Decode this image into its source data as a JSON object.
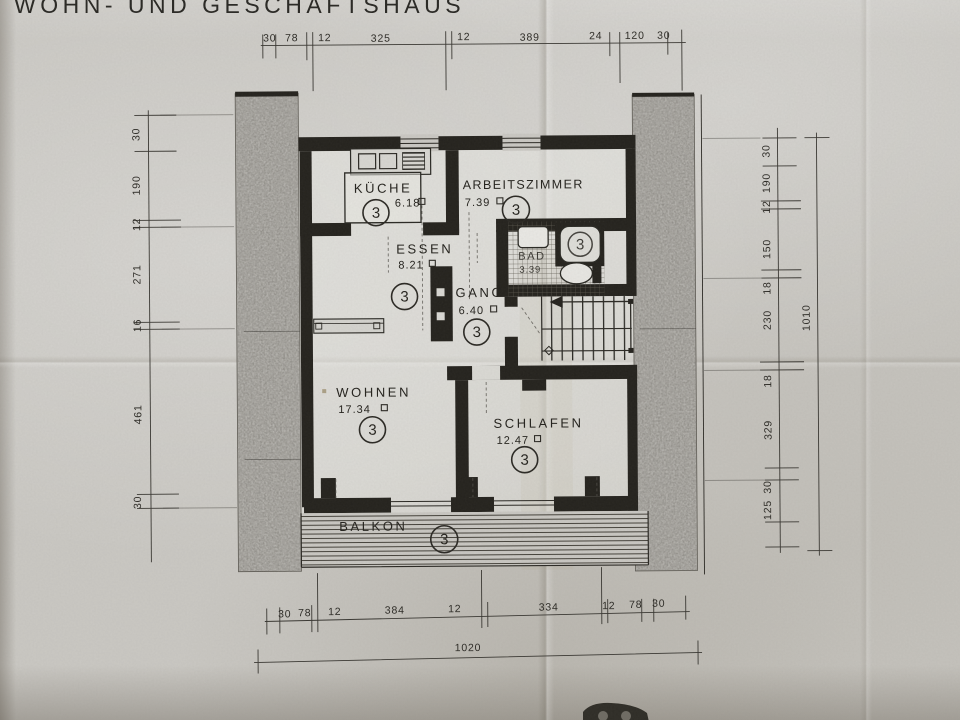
{
  "title": "WOHN- UND GESCHÄFTSHAUS",
  "plan": {
    "rooms": {
      "kueche": {
        "name": "KÜCHE",
        "area": "6.18",
        "apartment": "3"
      },
      "arbeitszimmer": {
        "name": "ARBEITSZIMMER",
        "area": "7.39",
        "apartment": "3"
      },
      "essen": {
        "name": "ESSEN",
        "area": "8.21",
        "apartment": "3"
      },
      "bad": {
        "name": "BAD",
        "area": "3.39",
        "apartment": "3"
      },
      "gang": {
        "name": "GANG",
        "area": "6.40",
        "apartment": "3"
      },
      "wohnen": {
        "name": "WOHNEN",
        "area": "17.34",
        "apartment": "3"
      },
      "schlafen": {
        "name": "SCHLAFEN",
        "area": "12.47",
        "apartment": "3"
      },
      "balkon": {
        "name": "BALKON",
        "apartment": "3"
      }
    }
  },
  "dimensions": {
    "top": [
      "30",
      "78",
      "12",
      "325",
      "12",
      "389",
      "24",
      "120",
      "30"
    ],
    "left": [
      "30",
      "190",
      "12",
      "271",
      "16",
      "461",
      "30"
    ],
    "right": [
      "30",
      "190",
      "12",
      "150",
      "18",
      "230",
      "18",
      "329",
      "30",
      "125"
    ],
    "right_total": "1010",
    "bottom": [
      "30",
      "78",
      "12",
      "384",
      "12",
      "334",
      "12",
      "78",
      "30"
    ],
    "bottom_total": "1020"
  },
  "colors": {
    "paper": "#c9c7c2",
    "ink": "#26241f",
    "masonry": "#b5b3ae"
  }
}
